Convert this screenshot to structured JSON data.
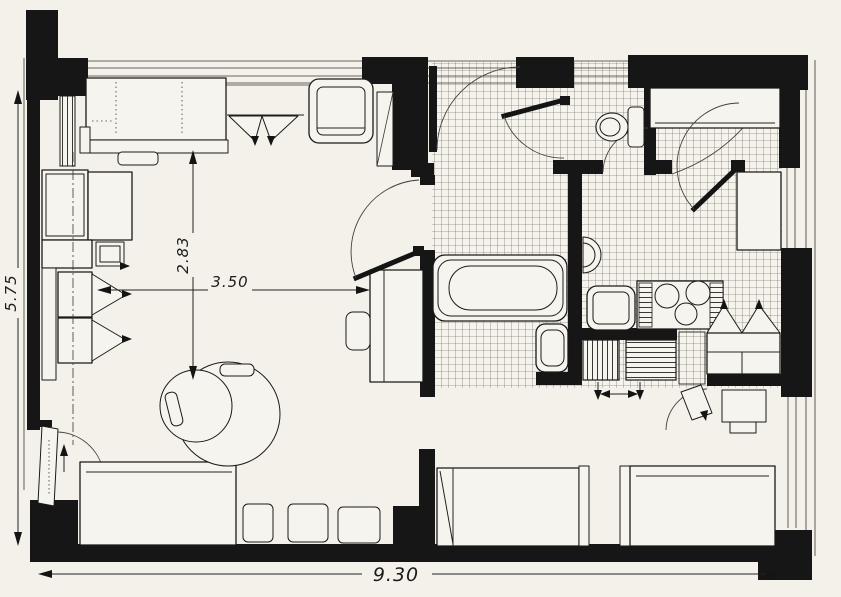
{
  "figure": {
    "type": "architectural-floor-plan",
    "colors": {
      "paper": "#f3f1ea",
      "ink": "#161616",
      "tile_line": "#55504a"
    },
    "labels": {
      "overall_height": "5.75",
      "overall_width": "9.30",
      "living_width": "3.50",
      "living_depth": "2.83"
    }
  }
}
